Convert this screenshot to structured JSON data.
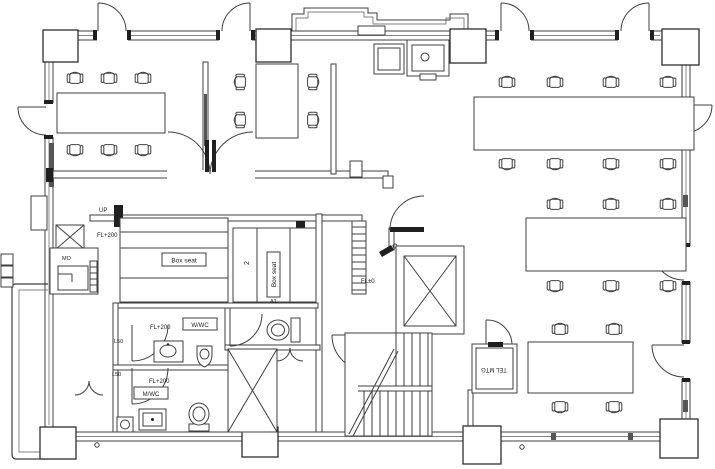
{
  "drawing": {
    "type": "architectural floor plan (office level)",
    "labels": {
      "up": "UP",
      "fl_plus_200_entry": "FL+200",
      "box_seat_horizontal": "Box seat",
      "box_seat_vertical": "Box seat",
      "section_mark_2": "2",
      "section_mark_a1": "A1",
      "fl_plus_200_women": "FL+200",
      "women_wc": "W/WC",
      "door_mark_l50_upper": "L50",
      "door_mark_l50_lower": "L50",
      "fl_plus_200_men": "FL+200",
      "men_wc": "M/WC",
      "fl_zero": "FL±0",
      "tel_meeting": "TEL MTG",
      "service_box": "MO"
    },
    "rooms": [
      {
        "name": "meeting-room-1",
        "chairs": 6,
        "tables": 1
      },
      {
        "name": "meeting-room-2",
        "chairs": 4,
        "tables": 1
      },
      {
        "name": "open-office-area",
        "chairs": 18,
        "tables": 3
      },
      {
        "name": "box-seat-area",
        "bench_rows": 2,
        "label": "Box seat"
      },
      {
        "name": "women-wc",
        "label": "W/WC",
        "fixtures": [
          "toilet",
          "urinal",
          "sink"
        ]
      },
      {
        "name": "men-wc",
        "label": "M/WC",
        "fixtures": [
          "toilet",
          "sink",
          "mop-sink"
        ]
      },
      {
        "name": "tel-meeting-booth",
        "label": "TEL MTG"
      },
      {
        "name": "elevator-shaft"
      },
      {
        "name": "stairwell"
      },
      {
        "name": "service-shaft"
      },
      {
        "name": "balcony-left"
      }
    ],
    "fixture_icons": [
      "chair-icon",
      "meeting-table-icon",
      "door-swing-icon",
      "elevator-x-icon",
      "stairs-icon",
      "steps-icon",
      "toilet-icon",
      "urinal-icon",
      "sink-icon",
      "copier-icon",
      "shaft-x-icon",
      "bench-icon"
    ],
    "colors": {
      "line": "#3f3f3f",
      "dark_fill": "#1f1f1f",
      "glass": "#555555",
      "background": "#ffffff"
    }
  }
}
